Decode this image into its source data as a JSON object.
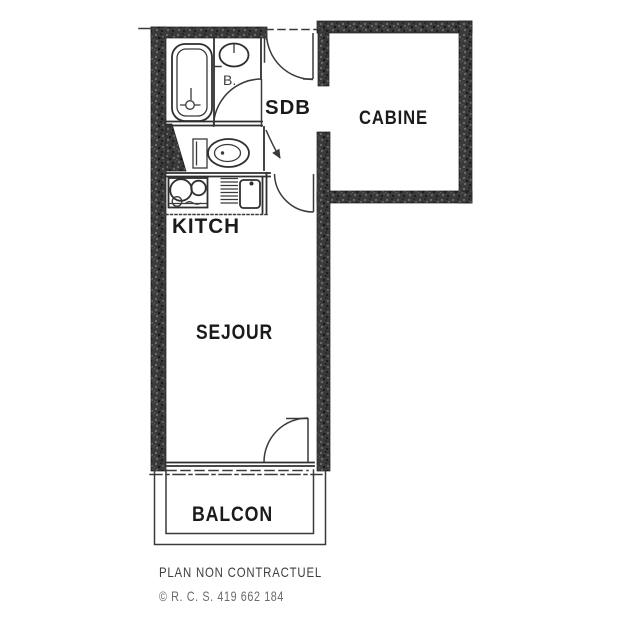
{
  "plan": {
    "rooms": {
      "sdb": "SDB",
      "cabine": "CABINE",
      "kitch": "KITCH",
      "sejour": "SEJOUR",
      "balcon": "BALCON"
    },
    "annotations": {
      "bath": "B."
    },
    "icons": {
      "fixtures": [
        "bathtub-icon",
        "washbasin-icon",
        "toilet-icon",
        "stove-icon",
        "drainboard-icon",
        "sink-icon"
      ],
      "doors": [
        "entry-door-swing",
        "sdb-door-swing",
        "wc-door-swing",
        "hall-sejour-door-swing",
        "balcony-door-swing"
      ]
    },
    "colors": {
      "background": "#ffffff",
      "wall": "#3a3a3a",
      "wall_speckle_light": "#6f6f6f",
      "wall_speckle_dark": "#141414",
      "line": "#2f2f2f",
      "label_text": "#1b1b1b",
      "disclaimer_text": "#3e3e3e",
      "copyright_text": "#6b6b6b"
    }
  },
  "footer": {
    "disclaimer": "PLAN NON CONTRACTUEL",
    "copyright": "© R. C. S. 419 662 184"
  }
}
